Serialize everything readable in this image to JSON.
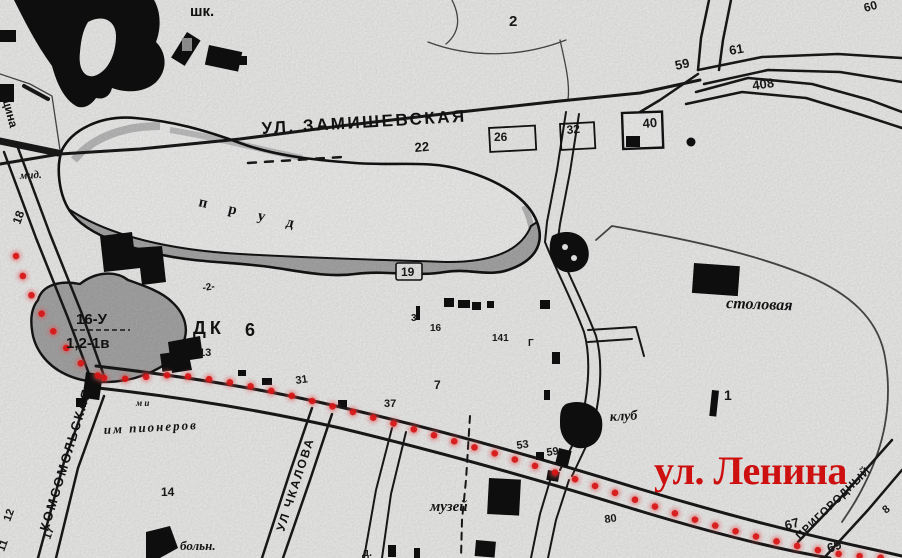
{
  "map": {
    "streets": {
      "zamishevskaya": "УЛ. ЗАМИШЕВСКАЯ",
      "lenina_red": "ул. Ленина",
      "komsomolskaya": "КОМСОМОЛЬСКАЯ",
      "chkalova": "УЛ ЧКАЛОВА",
      "prigorodny": "ПРИГОРОДНЫЙ",
      "edge_fragment": "щина"
    },
    "places": {
      "school": "шк.",
      "pond": "п р у д",
      "dk": "ДК",
      "dk_num": "6",
      "stolovaya": "столовая",
      "klub": "клуб",
      "muzey": "музей",
      "bolnica": "больн.",
      "pioneers": "им пионеров",
      "pioneers_small": "м и",
      "mid": "мид.",
      "hill_line1": "16-У",
      "hill_line2": "1,2-1в",
      "band_mark": "-2-"
    },
    "plot_numbers": [
      "2",
      "59",
      "61",
      "60",
      "408",
      "40",
      "26",
      "32",
      "22",
      "19",
      "13",
      "18",
      "31",
      "37",
      "7",
      "3",
      "16",
      "141",
      "Г",
      "14",
      "12",
      "17",
      "11",
      "53",
      "59",
      "80",
      "1",
      "67",
      "69",
      "8",
      "д."
    ],
    "route": {
      "style": "red dotted line",
      "along": "ул. Ленина"
    },
    "colors": {
      "paper": "#f4f4f3",
      "ink": "#1a1a1a",
      "water_band": "#acacac",
      "hill_gray": "#ababab",
      "route_dot": "#ee1616",
      "street_red": "#e51212"
    }
  }
}
